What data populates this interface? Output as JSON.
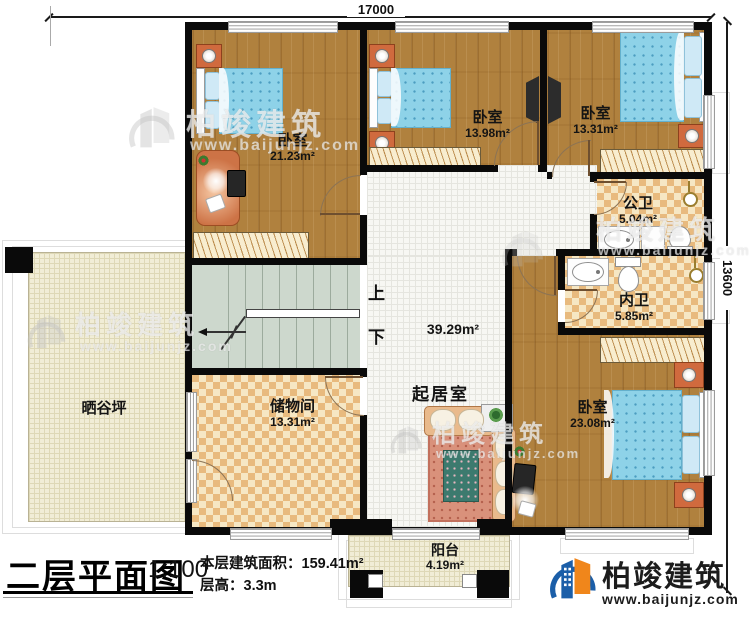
{
  "plan": {
    "title": "二层平面图",
    "scale": "1:100",
    "floor_area_label": "本层建筑面积：",
    "floor_area_value": "159.41m²",
    "floor_height_label": "层高：",
    "floor_height_value": "3.3m"
  },
  "dimensions": {
    "width_mm": "17000",
    "height_mm": "13600"
  },
  "rooms": {
    "bedroom_left": {
      "name": "卧室",
      "area": "21.23m²"
    },
    "bedroom_mid": {
      "name": "卧室",
      "area": "13.98m²"
    },
    "bedroom_right": {
      "name": "卧室",
      "area": "13.31m²"
    },
    "bedroom_bottom": {
      "name": "卧室",
      "area": "23.08m²"
    },
    "public_bath": {
      "name": "公卫",
      "area": "5.04m²"
    },
    "inner_bath": {
      "name": "内卫",
      "area": "5.85m²"
    },
    "living": {
      "name": "起居室",
      "area": "39.29m²"
    },
    "storage": {
      "name": "储物间",
      "area": "13.31m²"
    },
    "drying_yard": {
      "name": "晒谷坪"
    },
    "balcony": {
      "name": "阳台",
      "area": "4.19m²"
    }
  },
  "stairs": {
    "up_label": "上",
    "down_label": "下"
  },
  "branding": {
    "company": "柏竣建筑",
    "website": "www.baijunjz.com"
  },
  "watermark": {
    "company": "柏竣建筑",
    "website": "www.baijunjz.com"
  },
  "colors": {
    "wall": "#0a0a0a",
    "wood": "#b0813e",
    "tile": "#e8ba7e",
    "brand_blue": "#1b5ea8",
    "brand_orange": "#f0861b"
  }
}
